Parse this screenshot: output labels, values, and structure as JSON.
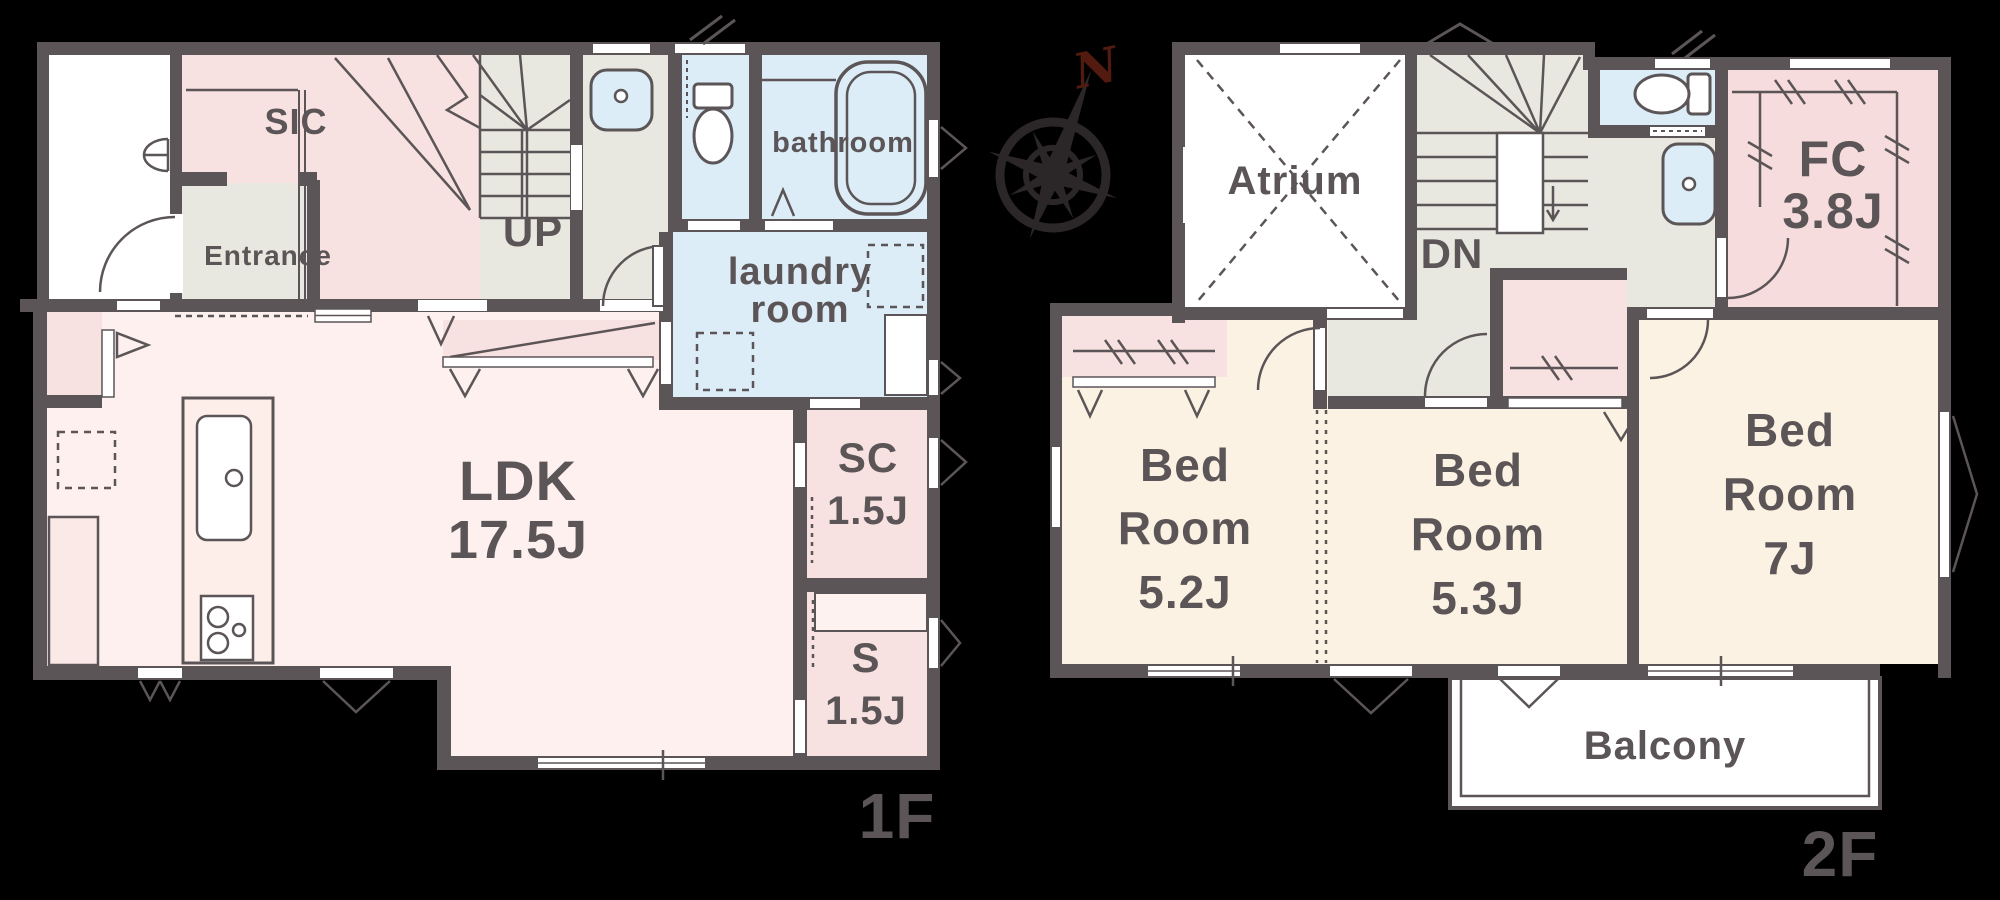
{
  "compass": {
    "north": "N"
  },
  "floor1": {
    "tag": "1F",
    "sic": "SIC",
    "entrance": "Entrance",
    "up": "UP",
    "bathroom": "bathroom",
    "laundry_line1": "laundry",
    "laundry_line2": "room",
    "ldk": "LDK",
    "ldk_size": "17.5J",
    "shoe_closet": "SC",
    "shoe_closet_size": "1.5J",
    "storage": "S",
    "storage_size": "1.5J"
  },
  "floor2": {
    "tag": "2F",
    "atrium": "Atrium",
    "dn": "DN",
    "family_closet": "FC",
    "family_closet_size": "3.8J",
    "bedroom1": {
      "l1": "Bed",
      "l2": "Room",
      "l3": "5.2J"
    },
    "bedroom2": {
      "l1": "Bed",
      "l2": "Room",
      "l3": "5.3J"
    },
    "bedroom3": {
      "l1": "Bed",
      "l2": "Room",
      "l3": "7J"
    },
    "balcony": "Balcony"
  },
  "colors": {
    "wall": "#5b5557",
    "room_pink": "#f8e2e1",
    "ldk_pink": "#fdf0ee",
    "hall_green": "#e9e8e0",
    "wet_blue": "#dcedf8",
    "bedroom_cream": "#fcf2e3",
    "family_closet_pink": "#f6dcdc",
    "north_letter": "#531b10",
    "background": "#000000"
  }
}
